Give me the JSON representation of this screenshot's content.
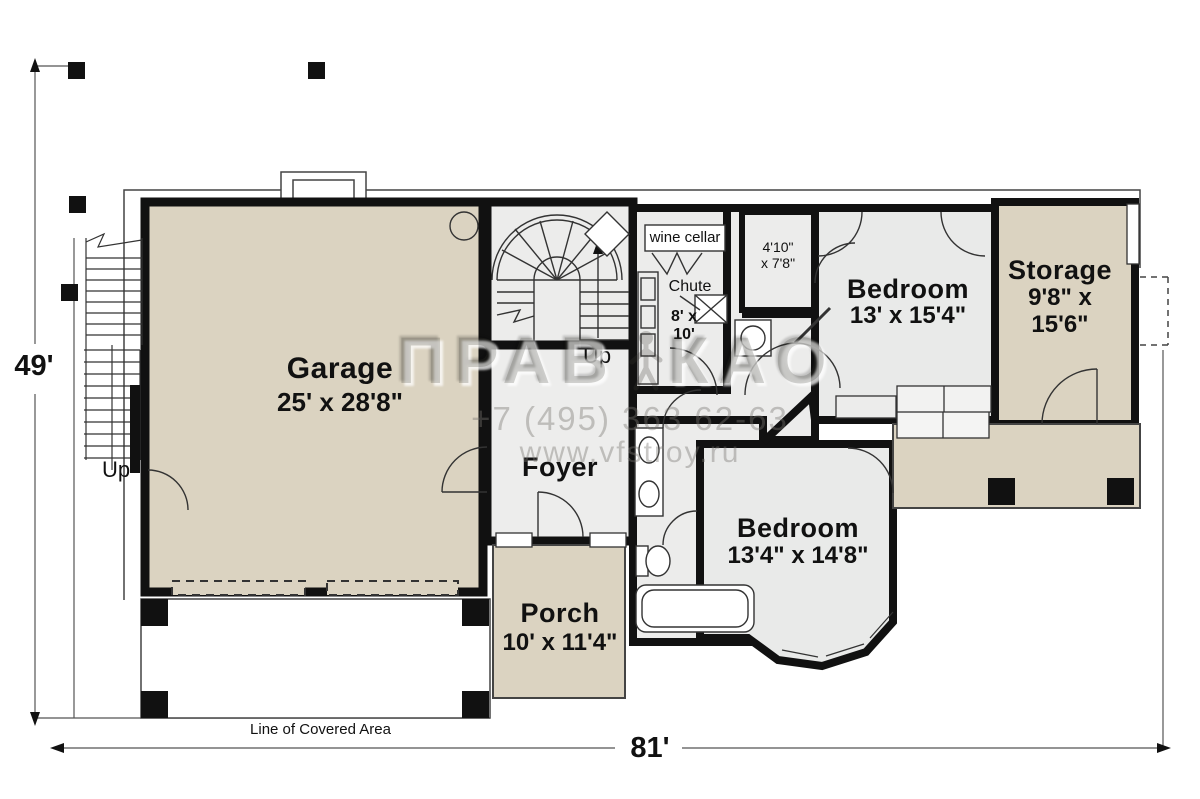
{
  "dimensions": {
    "overall_width": "81'",
    "overall_height": "49'"
  },
  "rooms": {
    "garage": {
      "name": "Garage",
      "dims": "25' x 28'8\""
    },
    "foyer": {
      "name": "Foyer"
    },
    "porch": {
      "name": "Porch",
      "dims": "10' x 11'4\""
    },
    "bedroom_upper": {
      "name": "Bedroom",
      "dims": "13' x 15'4\""
    },
    "bedroom_lower": {
      "name": "Bedroom",
      "dims": "13'4\" x 14'8\""
    },
    "storage": {
      "name": "Storage",
      "dims": "9'8\" x\n15'6\""
    },
    "wine_cellar": {
      "name": "wine cellar",
      "dims": "8' x\n10'"
    },
    "closet": {
      "dims": "4'10\"\nx 7'8\""
    }
  },
  "labels": {
    "chute": "Chute",
    "up_exterior": "Up",
    "up_interior": "Up",
    "covered_area": "Line of Covered Area"
  },
  "watermark": {
    "logo_left": "ПРАВ",
    "logo_right": "КАО",
    "phone": "+7 (495) 363 62-63",
    "website": "www.vfstroy.ru"
  },
  "colors": {
    "floor_tan": "#dbd3c1",
    "floor_gray": "#ececeb",
    "wall": "#111111"
  }
}
